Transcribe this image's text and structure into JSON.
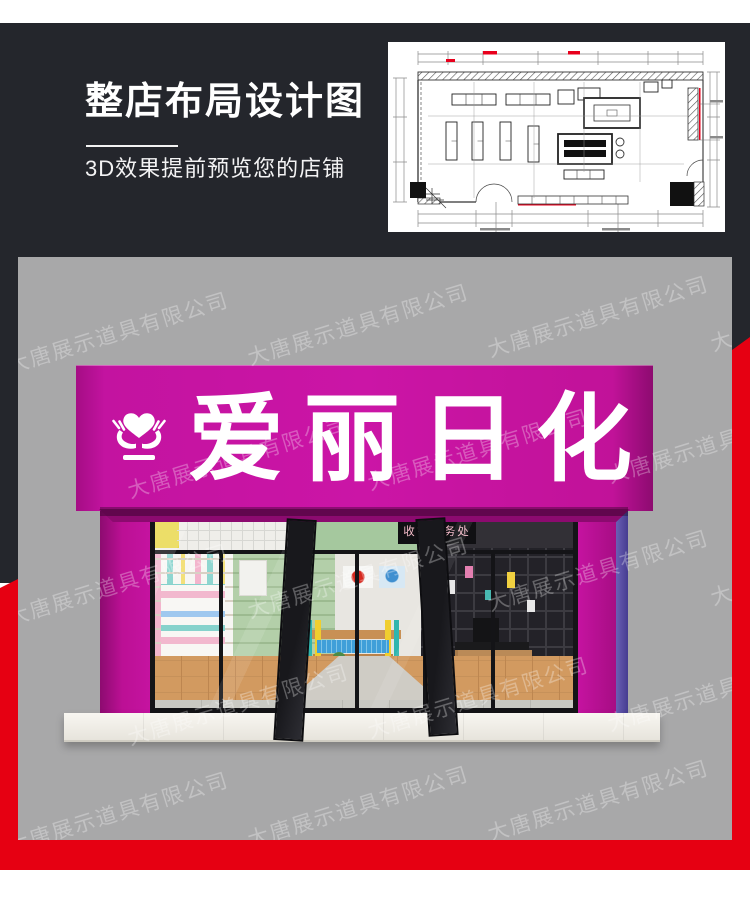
{
  "hero": {
    "title": "整店布局设计图",
    "subtitle": "3D效果提前预览您的店铺",
    "bg_color": "#24262c",
    "text_color": "#ffffff"
  },
  "floorplan": {
    "description": "store-layout-cad-plan",
    "bg_color": "#ffffff",
    "line_color": "#3a3a3a",
    "accent_red": "#e8001c"
  },
  "frame": {
    "charcoal": "#24262c",
    "red": "#e60012",
    "panel_gray": "#a8a8a9"
  },
  "storefront": {
    "sign": {
      "text": "爱丽日化",
      "bg_color": "#c513a0",
      "text_color": "#ffffff",
      "logo": "heart-in-hands"
    },
    "cashier_sign": {
      "text": "收银服务处",
      "bg_color": "#101013",
      "text_color": "#f3bac8"
    }
  },
  "watermark": {
    "text": "大唐展示道具有限公司",
    "color": "rgba(255,255,255,0.30)",
    "positions": [
      [
        -15,
        60
      ],
      [
        225,
        52
      ],
      [
        465,
        44
      ],
      [
        688,
        38
      ],
      [
        105,
        185
      ],
      [
        345,
        177
      ],
      [
        585,
        170
      ],
      [
        -15,
        312
      ],
      [
        225,
        305
      ],
      [
        465,
        298
      ],
      [
        688,
        292
      ],
      [
        105,
        432
      ],
      [
        345,
        425
      ],
      [
        585,
        418
      ],
      [
        -15,
        540
      ],
      [
        225,
        534
      ],
      [
        465,
        528
      ]
    ]
  }
}
